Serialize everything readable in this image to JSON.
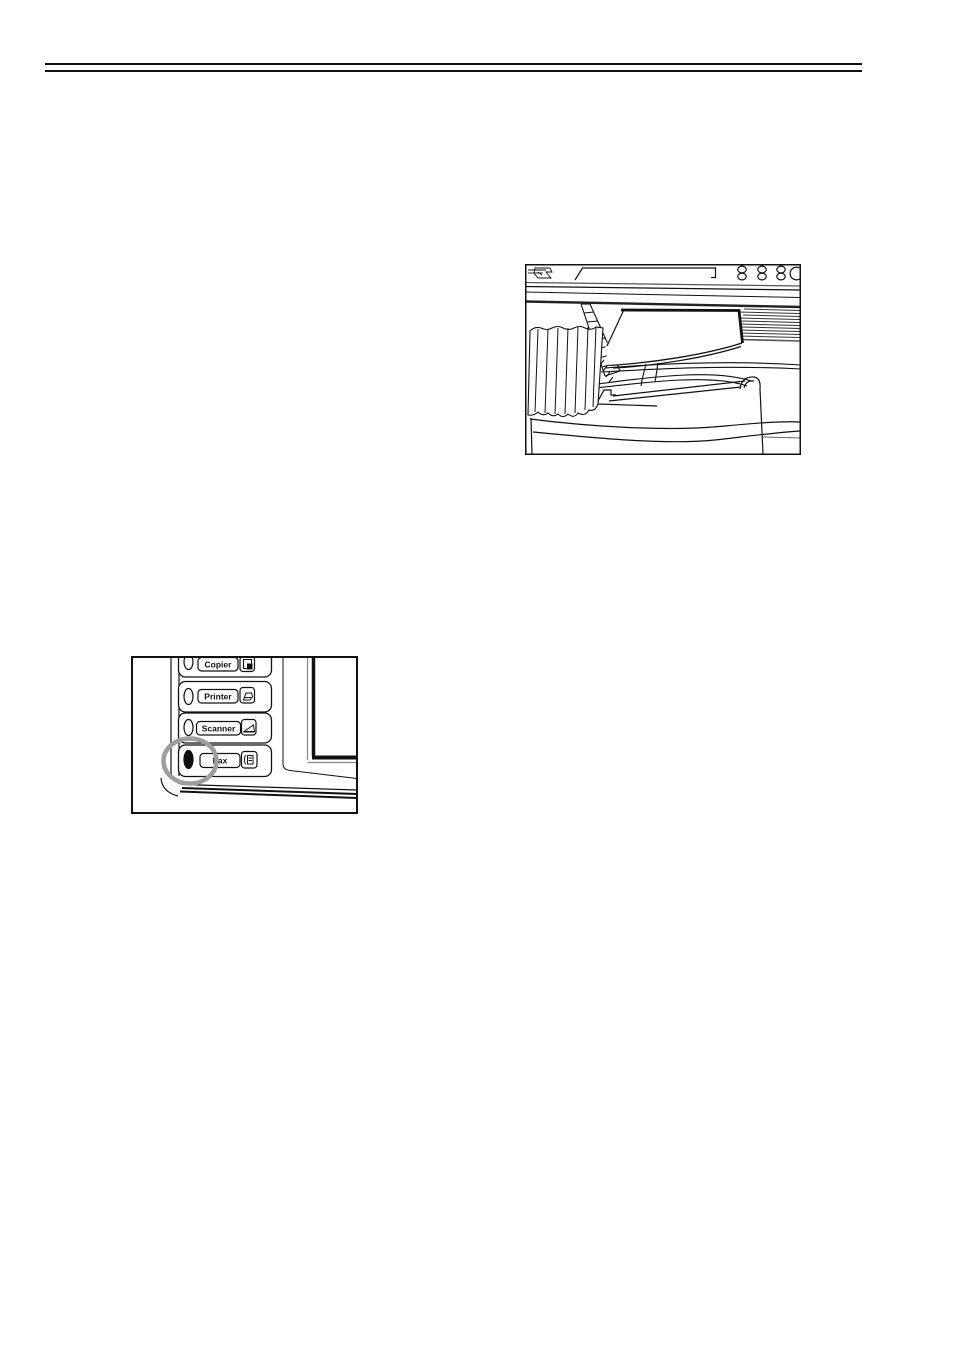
{
  "page": {
    "background": "#ffffff",
    "rule_color": "#111111"
  },
  "figure_machine": {
    "alt": "line drawing of fax machine top with document feeder and original loaded",
    "parts": [
      "brand-mark",
      "operation-panel",
      "operation-buttons",
      "document-original",
      "feed-tray",
      "paper-stack",
      "output-hook"
    ]
  },
  "figure_panel": {
    "alt": "line drawing of control panel application keys beside display",
    "buttons": [
      {
        "label": "Copier",
        "icon": "copier-icon",
        "led": "off"
      },
      {
        "label": "Printer",
        "icon": "printer-icon",
        "led": "off"
      },
      {
        "label": "Scanner",
        "icon": "scanner-icon",
        "led": "off"
      },
      {
        "label": "Fax",
        "icon": "fax-icon",
        "led": "on"
      }
    ],
    "highlight": {
      "color": "#9e9e9e",
      "target": "fax-key-led"
    }
  }
}
